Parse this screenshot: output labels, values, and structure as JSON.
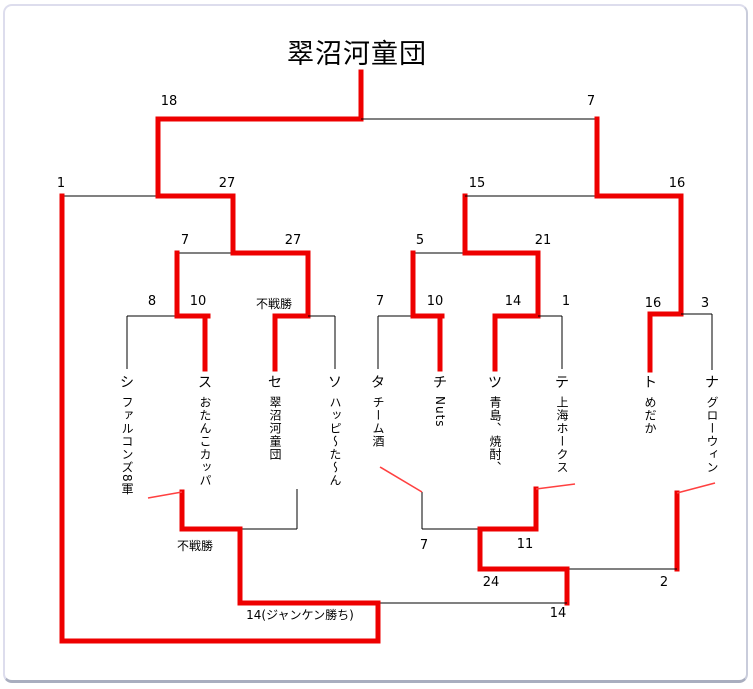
{
  "title": "翠沼河童団",
  "colors": {
    "winner": "#ee0000",
    "line": "#000000",
    "diagonal": "#ff4040"
  },
  "teams": [
    {
      "label": "シ",
      "name": "ファルコンズ8軍",
      "x": 122
    },
    {
      "label": "ス",
      "name": "おたんこカッパ",
      "x": 200
    },
    {
      "label": "セ",
      "name": "翠沼河童団",
      "x": 270
    },
    {
      "label": "ソ",
      "name": "ハッピ～た～ん",
      "x": 330
    },
    {
      "label": "タ",
      "name": "チーム酒",
      "x": 373
    },
    {
      "label": "チ",
      "name": "Nuts",
      "x": 435
    },
    {
      "label": "ツ",
      "name": "青島、焼酎、",
      "x": 490
    },
    {
      "label": "テ",
      "name": "上海ホークス",
      "x": 557
    },
    {
      "label": "ト",
      "name": "めだか",
      "x": 645
    },
    {
      "label": "ナ",
      "name": "グローウィン",
      "x": 707
    }
  ],
  "team_label_y": 366,
  "team_name_y": 390,
  "matches": [
    {
      "a": "シ",
      "b": "ス",
      "score_a": "8",
      "score_b": "10",
      "winner": "ス"
    },
    {
      "a": "セ",
      "b": "ソ",
      "score_a": "不戦勝",
      "score_b": "",
      "winner": "セ"
    },
    {
      "a": "タ",
      "b": "チ",
      "score_a": "7",
      "score_b": "10",
      "winner": "チ"
    },
    {
      "a": "ツ",
      "b": "テ",
      "score_a": "14",
      "score_b": "1",
      "winner": "ツ"
    },
    {
      "a": "ト",
      "b": "ナ",
      "score_a": "16",
      "score_b": "3",
      "winner": "ト"
    },
    {
      "a": "ス",
      "b": "セ",
      "score_a": "7",
      "score_b": "27",
      "winner": "セ"
    },
    {
      "a": "チ",
      "b": "ツ",
      "score_a": "5",
      "score_b": "21",
      "winner": "ツ"
    },
    {
      "a": "復活シ",
      "b": "セ",
      "score_a": "1",
      "score_b": "27",
      "winner": "セ"
    },
    {
      "a": "ツ",
      "b": "ト",
      "score_a": "15",
      "score_b": "16",
      "winner": "ト"
    },
    {
      "a": "セ",
      "b": "ト",
      "score_a": "18",
      "score_b": "7",
      "winner": "セ"
    },
    {
      "a": "シ",
      "b": "ソ",
      "score_a": "不戦勝",
      "score_b": "",
      "winner": "シ"
    },
    {
      "a": "タ",
      "b": "テ",
      "score_a": "7",
      "score_b": "11",
      "winner": "テ"
    },
    {
      "a": "テ",
      "b": "ナ",
      "score_a": "24",
      "score_b": "2",
      "winner": "テ"
    },
    {
      "a": "シ",
      "b": "テ",
      "score_a": "14(ジャンケン勝ち)",
      "score_b": "14",
      "winner": "シ"
    }
  ],
  "labels": [
    {
      "text": "18",
      "x": 164,
      "y": 88
    },
    {
      "text": "7",
      "x": 586,
      "y": 88
    },
    {
      "text": "1",
      "x": 56,
      "y": 170
    },
    {
      "text": "27",
      "x": 222,
      "y": 170
    },
    {
      "text": "15",
      "x": 472,
      "y": 170
    },
    {
      "text": "16",
      "x": 672,
      "y": 170
    },
    {
      "text": "7",
      "x": 180,
      "y": 227
    },
    {
      "text": "27",
      "x": 288,
      "y": 227
    },
    {
      "text": "5",
      "x": 415,
      "y": 227
    },
    {
      "text": "21",
      "x": 538,
      "y": 227
    },
    {
      "text": "8",
      "x": 147,
      "y": 288
    },
    {
      "text": "10",
      "x": 193,
      "y": 288
    },
    {
      "text": "不戦勝",
      "x": 269,
      "y": 289,
      "jp": true
    },
    {
      "text": "7",
      "x": 375,
      "y": 288
    },
    {
      "text": "10",
      "x": 430,
      "y": 288
    },
    {
      "text": "14",
      "x": 508,
      "y": 288
    },
    {
      "text": "1",
      "x": 561,
      "y": 288
    },
    {
      "text": "16",
      "x": 648,
      "y": 290
    },
    {
      "text": "3",
      "x": 700,
      "y": 290
    },
    {
      "text": "不戦勝",
      "x": 190,
      "y": 531,
      "jp": true
    },
    {
      "text": "7",
      "x": 419,
      "y": 532
    },
    {
      "text": "11",
      "x": 520,
      "y": 531
    },
    {
      "text": "24",
      "x": 486,
      "y": 569
    },
    {
      "text": "2",
      "x": 659,
      "y": 569
    },
    {
      "text": "14(ジャンケン勝ち)",
      "x": 295,
      "y": 600,
      "jp": true
    },
    {
      "text": "14",
      "x": 553,
      "y": 600
    }
  ],
  "lines": [
    {
      "x1": 356,
      "y1": 66,
      "x2": 356,
      "y2": 113,
      "c": "w"
    },
    {
      "x1": 153,
      "y1": 113,
      "x2": 356,
      "y2": 113,
      "c": "w"
    },
    {
      "x1": 356,
      "y1": 113,
      "x2": 592,
      "y2": 113,
      "c": "b"
    },
    {
      "x1": 153,
      "y1": 113,
      "x2": 153,
      "y2": 190,
      "c": "w"
    },
    {
      "x1": 592,
      "y1": 113,
      "x2": 592,
      "y2": 190,
      "c": "w"
    },
    {
      "x1": 57,
      "y1": 190,
      "x2": 153,
      "y2": 190,
      "c": "b"
    },
    {
      "x1": 153,
      "y1": 190,
      "x2": 228,
      "y2": 190,
      "c": "w"
    },
    {
      "x1": 57,
      "y1": 190,
      "x2": 57,
      "y2": 635,
      "c": "w"
    },
    {
      "x1": 228,
      "y1": 190,
      "x2": 228,
      "y2": 247,
      "c": "w"
    },
    {
      "x1": 172,
      "y1": 247,
      "x2": 228,
      "y2": 247,
      "c": "b"
    },
    {
      "x1": 228,
      "y1": 247,
      "x2": 303,
      "y2": 247,
      "c": "w"
    },
    {
      "x1": 172,
      "y1": 247,
      "x2": 172,
      "y2": 310,
      "c": "w"
    },
    {
      "x1": 303,
      "y1": 247,
      "x2": 303,
      "y2": 310,
      "c": "w"
    },
    {
      "x1": 122,
      "y1": 310,
      "x2": 172,
      "y2": 310,
      "c": "b"
    },
    {
      "x1": 172,
      "y1": 310,
      "x2": 203,
      "y2": 310,
      "c": "w"
    },
    {
      "x1": 122,
      "y1": 310,
      "x2": 122,
      "y2": 363,
      "c": "b"
    },
    {
      "x1": 200,
      "y1": 310,
      "x2": 200,
      "y2": 363,
      "c": "w"
    },
    {
      "x1": 270,
      "y1": 310,
      "x2": 303,
      "y2": 310,
      "c": "w"
    },
    {
      "x1": 303,
      "y1": 310,
      "x2": 330,
      "y2": 310,
      "c": "b"
    },
    {
      "x1": 270,
      "y1": 310,
      "x2": 270,
      "y2": 363,
      "c": "w"
    },
    {
      "x1": 330,
      "y1": 310,
      "x2": 330,
      "y2": 363,
      "c": "b"
    },
    {
      "x1": 408,
      "y1": 247,
      "x2": 460,
      "y2": 247,
      "c": "b"
    },
    {
      "x1": 460,
      "y1": 247,
      "x2": 533,
      "y2": 247,
      "c": "w"
    },
    {
      "x1": 460,
      "y1": 190,
      "x2": 460,
      "y2": 247,
      "c": "w"
    },
    {
      "x1": 408,
      "y1": 247,
      "x2": 408,
      "y2": 310,
      "c": "w"
    },
    {
      "x1": 533,
      "y1": 247,
      "x2": 533,
      "y2": 310,
      "c": "w"
    },
    {
      "x1": 373,
      "y1": 310,
      "x2": 408,
      "y2": 310,
      "c": "b"
    },
    {
      "x1": 408,
      "y1": 310,
      "x2": 437,
      "y2": 310,
      "c": "w"
    },
    {
      "x1": 373,
      "y1": 310,
      "x2": 373,
      "y2": 363,
      "c": "b"
    },
    {
      "x1": 435,
      "y1": 310,
      "x2": 435,
      "y2": 363,
      "c": "w"
    },
    {
      "x1": 490,
      "y1": 310,
      "x2": 533,
      "y2": 310,
      "c": "w"
    },
    {
      "x1": 533,
      "y1": 310,
      "x2": 557,
      "y2": 310,
      "c": "b"
    },
    {
      "x1": 490,
      "y1": 310,
      "x2": 490,
      "y2": 363,
      "c": "w"
    },
    {
      "x1": 557,
      "y1": 310,
      "x2": 557,
      "y2": 363,
      "c": "b"
    },
    {
      "x1": 460,
      "y1": 190,
      "x2": 592,
      "y2": 190,
      "c": "b"
    },
    {
      "x1": 592,
      "y1": 190,
      "x2": 676,
      "y2": 190,
      "c": "w"
    },
    {
      "x1": 676,
      "y1": 190,
      "x2": 676,
      "y2": 308,
      "c": "w"
    },
    {
      "x1": 645,
      "y1": 308,
      "x2": 676,
      "y2": 308,
      "c": "w"
    },
    {
      "x1": 676,
      "y1": 308,
      "x2": 707,
      "y2": 308,
      "c": "b"
    },
    {
      "x1": 645,
      "y1": 308,
      "x2": 645,
      "y2": 364,
      "c": "w"
    },
    {
      "x1": 707,
      "y1": 308,
      "x2": 707,
      "y2": 364,
      "c": "b"
    },
    {
      "x1": 177,
      "y1": 486,
      "x2": 177,
      "y2": 523,
      "c": "w"
    },
    {
      "x1": 292,
      "y1": 483,
      "x2": 292,
      "y2": 523,
      "c": "b"
    },
    {
      "x1": 177,
      "y1": 523,
      "x2": 235,
      "y2": 523,
      "c": "w"
    },
    {
      "x1": 235,
      "y1": 523,
      "x2": 292,
      "y2": 523,
      "c": "b"
    },
    {
      "x1": 235,
      "y1": 523,
      "x2": 235,
      "y2": 597,
      "c": "w"
    },
    {
      "x1": 417,
      "y1": 486,
      "x2": 417,
      "y2": 523,
      "c": "b"
    },
    {
      "x1": 531,
      "y1": 483,
      "x2": 531,
      "y2": 523,
      "c": "w"
    },
    {
      "x1": 417,
      "y1": 523,
      "x2": 475,
      "y2": 523,
      "c": "b"
    },
    {
      "x1": 475,
      "y1": 523,
      "x2": 531,
      "y2": 523,
      "c": "w"
    },
    {
      "x1": 475,
      "y1": 523,
      "x2": 475,
      "y2": 563,
      "c": "w"
    },
    {
      "x1": 672,
      "y1": 487,
      "x2": 672,
      "y2": 563,
      "c": "w"
    },
    {
      "x1": 475,
      "y1": 563,
      "x2": 562,
      "y2": 563,
      "c": "w"
    },
    {
      "x1": 562,
      "y1": 563,
      "x2": 672,
      "y2": 563,
      "c": "b"
    },
    {
      "x1": 562,
      "y1": 563,
      "x2": 562,
      "y2": 597,
      "c": "w"
    },
    {
      "x1": 235,
      "y1": 597,
      "x2": 373,
      "y2": 597,
      "c": "w"
    },
    {
      "x1": 373,
      "y1": 597,
      "x2": 562,
      "y2": 597,
      "c": "b"
    },
    {
      "x1": 373,
      "y1": 597,
      "x2": 373,
      "y2": 635,
      "c": "w"
    },
    {
      "x1": 57,
      "y1": 635,
      "x2": 373,
      "y2": 635,
      "c": "w"
    }
  ],
  "diagonals": [
    {
      "x1": 143,
      "y1": 492,
      "x2": 177,
      "y2": 486
    },
    {
      "x1": 375,
      "y1": 461,
      "x2": 417,
      "y2": 486
    },
    {
      "x1": 570,
      "y1": 478,
      "x2": 531,
      "y2": 483
    },
    {
      "x1": 710,
      "y1": 477,
      "x2": 672,
      "y2": 487
    }
  ]
}
